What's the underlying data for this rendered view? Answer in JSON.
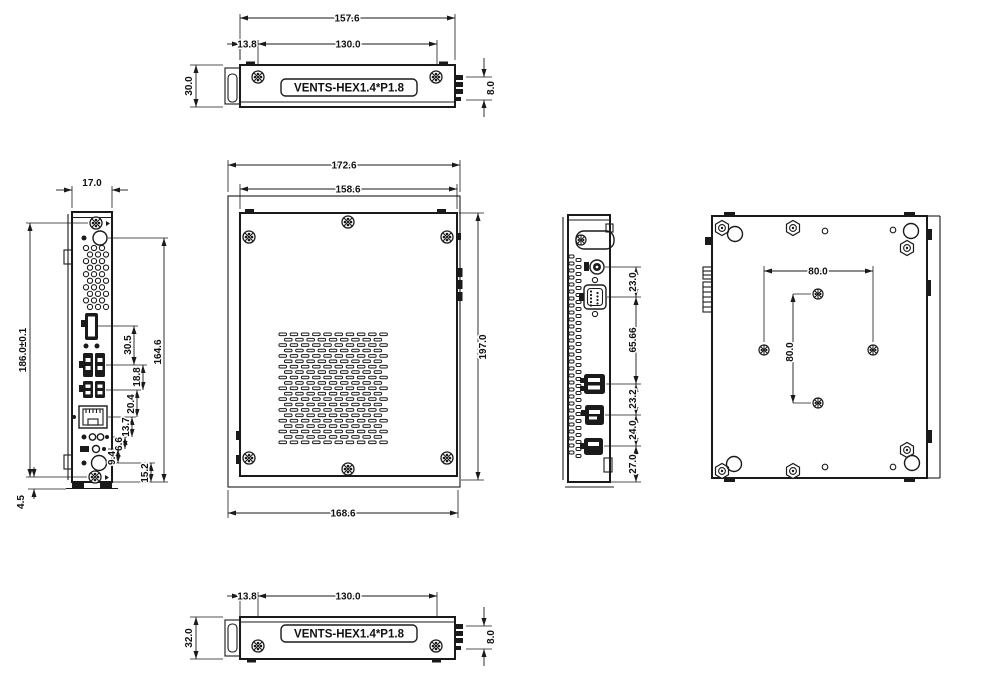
{
  "drawing": {
    "kind": "mechanical dimension drawing",
    "units": "mm",
    "colors": {
      "line": "#1a1a1a",
      "background": "#ffffff"
    }
  },
  "views": {
    "top": {
      "label": "VENTS-HEX1.4*P1.8",
      "dim_overall_width": "157.6",
      "dim_screw_offset": "13.8",
      "dim_screw_spacing": "130.0",
      "dim_depth": "30.0",
      "dim_connector": "8.0"
    },
    "underside_strip": {
      "label": "VENTS-HEX1.4*P1.8",
      "dim_screw_offset": "13.8",
      "dim_screw_spacing": "130.0",
      "dim_depth": "32.0",
      "dim_connector": "8.0"
    },
    "left": {
      "dim_top_width": "17.0",
      "dim_mount_span": "186.0±0.1",
      "dim_port_span": "164.6",
      "dim_hdmi_usb": "30.5",
      "dim_usb_usb": "18.8",
      "dim_usb_lan": "20.4",
      "dim_lan_audio": "13.7",
      "dim_audio_row": "6.6",
      "dim_row_button": "9.4",
      "dim_button_edge": "15.2",
      "dim_foot": "4.5"
    },
    "front": {
      "dim_overall_width": "172.6",
      "dim_body_width": "158.6",
      "dim_overall_height": "197.0",
      "dim_bottom_width": "168.6"
    },
    "right": {
      "dim_dc_jack": "23.0",
      "dim_com_usb": "65.66",
      "dim_usb_dp": "23.2",
      "dim_dp_hdmi": "24.0",
      "dim_hdmi_edge": "27.0"
    },
    "bottom": {
      "dim_vesa_width": "80.0",
      "dim_vesa_height": "80.0"
    }
  }
}
